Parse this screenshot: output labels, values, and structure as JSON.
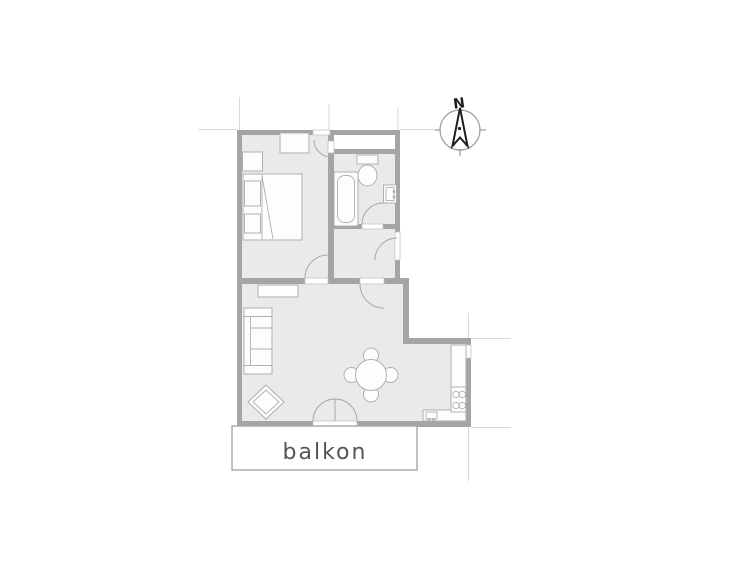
{
  "labels": {
    "balcony": "balkon",
    "compass_north": "N"
  },
  "colors": {
    "background": "#ffffff",
    "wall": "#a5a5a5",
    "room-fill": "#eaeaea",
    "furniture-fill": "#fdfdfd",
    "furniture-stroke": "#b0b0b0",
    "arc": "#a8a8a8",
    "opening-stroke": "#c2c2c2",
    "extension-line": "#d9d9d9",
    "balcony-stroke": "#ababab",
    "label-text": "#555555",
    "compass-ring": "#9a9a9a",
    "compass-ink": "#1f1f1f"
  }
}
